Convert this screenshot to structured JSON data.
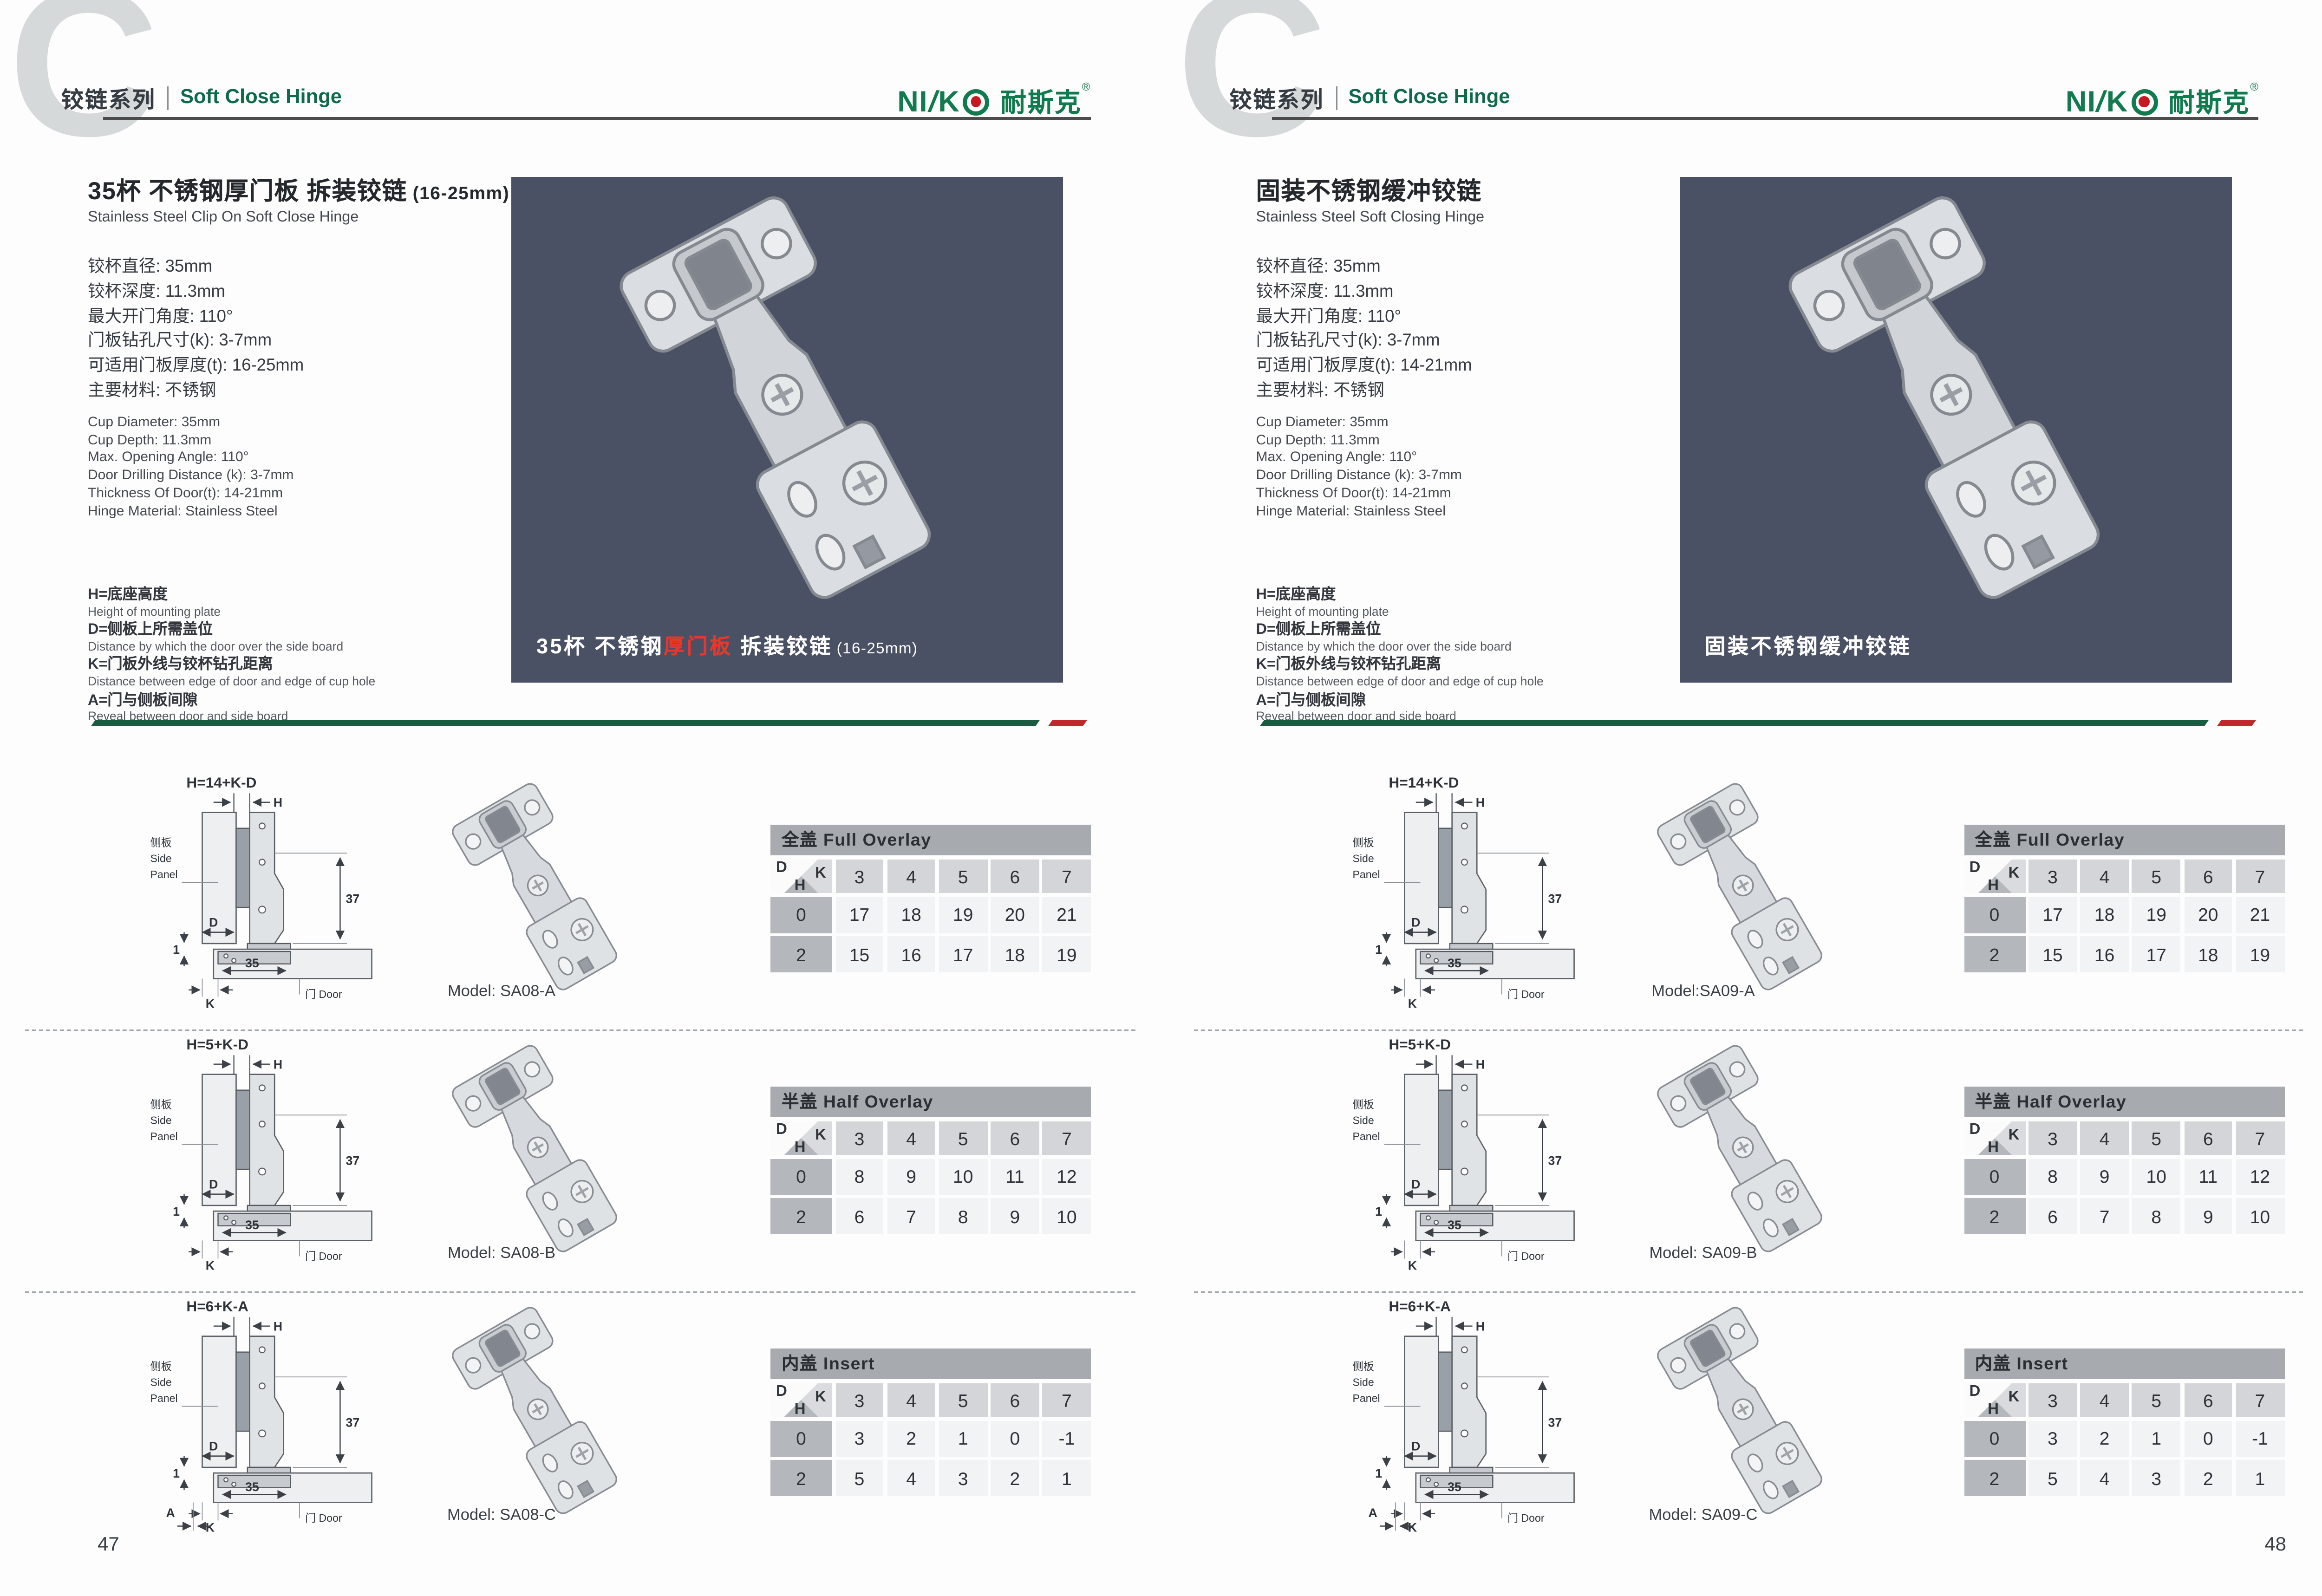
{
  "brand": {
    "logo_en_1": "NI",
    "logo_slash": "/",
    "logo_en_2": "K",
    "logo_cn": "耐斯克",
    "logo_reg": "®"
  },
  "header": {
    "letter": "C",
    "series_cn": "铰链系列",
    "series_en": "Soft Close Hinge"
  },
  "diagram_labels": {
    "h": "H",
    "d": "D",
    "k": "K",
    "a": "A",
    "one": "1",
    "thirtyseven": "37",
    "thirtyfive": "35",
    "side_cn": "侧板",
    "side_en_1": "Side",
    "side_en_2": "Panel",
    "door": "门 Door",
    "corner_d": "D",
    "corner_k": "K",
    "corner_h": "H"
  },
  "pages": [
    {
      "number": "47",
      "title_cn": "35杯 不锈钢厚门板 拆装铰链",
      "title_suffix": "(16-25mm)",
      "title_en": "Stainless Steel Clip On Soft Close Hinge",
      "specs_cn": [
        "铰杯直径: 35mm",
        "铰杯深度: 11.3mm",
        "最大开门角度: 110°",
        "门板钻孔尺寸(k): 3-7mm",
        "可适用门板厚度(t): 16-25mm",
        "主要材料: 不锈钢"
      ],
      "specs_en": [
        "Cup Diameter: 35mm",
        "Cup Depth: 11.3mm",
        "Max. Opening Angle: 110°",
        "Door Drilling Distance (k): 3-7mm",
        "Thickness Of Door(t): 14-21mm",
        "Hinge Material: Stainless Steel"
      ],
      "legend": [
        {
          "cn": "H=底座高度",
          "en": "Height of mounting plate"
        },
        {
          "cn": "D=侧板上所需盖位",
          "en": "Distance by which the door over the side board"
        },
        {
          "cn": "K=门板外线与铰杯钻孔距离",
          "en": "Distance between edge of door and edge of cup hole"
        },
        {
          "cn": "A=门与侧板间隙",
          "en": "Reveal between door and side board"
        }
      ],
      "caption": {
        "pre": "35杯 不锈钢",
        "red": "厚门板",
        "post": " 拆装铰链",
        "suffix": "(16-25mm)"
      },
      "sections": [
        {
          "formula": "H=14+K-D",
          "model": "Model: SA08-A",
          "dim_a": false,
          "table": {
            "title": "全盖 Full Overlay",
            "cols": [
              "3",
              "4",
              "5",
              "6",
              "7"
            ],
            "rows": [
              {
                "label": "0",
                "cells": [
                  "17",
                  "18",
                  "19",
                  "20",
                  "21"
                ]
              },
              {
                "label": "2",
                "cells": [
                  "15",
                  "16",
                  "17",
                  "18",
                  "19"
                ]
              }
            ]
          }
        },
        {
          "formula": "H=5+K-D",
          "model": "Model: SA08-B",
          "dim_a": false,
          "table": {
            "title": "半盖 Half Overlay",
            "cols": [
              "3",
              "4",
              "5",
              "6",
              "7"
            ],
            "rows": [
              {
                "label": "0",
                "cells": [
                  "8",
                  "9",
                  "10",
                  "11",
                  "12"
                ]
              },
              {
                "label": "2",
                "cells": [
                  "6",
                  "7",
                  "8",
                  "9",
                  "10"
                ]
              }
            ]
          }
        },
        {
          "formula": "H=6+K-A",
          "model": "Model: SA08-C",
          "dim_a": true,
          "table": {
            "title": "内盖 Insert",
            "cols": [
              "3",
              "4",
              "5",
              "6",
              "7"
            ],
            "rows": [
              {
                "label": "0",
                "cells": [
                  "3",
                  "2",
                  "1",
                  "0",
                  "-1"
                ]
              },
              {
                "label": "2",
                "cells": [
                  "5",
                  "4",
                  "3",
                  "2",
                  "1"
                ]
              }
            ]
          }
        }
      ]
    },
    {
      "number": "48",
      "title_cn": "固装不锈钢缓冲铰链",
      "title_suffix": "",
      "title_en": "Stainless Steel Soft Closing Hinge",
      "specs_cn": [
        "铰杯直径: 35mm",
        "铰杯深度: 11.3mm",
        "最大开门角度: 110°",
        "门板钻孔尺寸(k): 3-7mm",
        "可适用门板厚度(t): 14-21mm",
        "主要材料: 不锈钢"
      ],
      "specs_en": [
        "Cup Diameter: 35mm",
        "Cup Depth: 11.3mm",
        "Max. Opening Angle: 110°",
        "Door Drilling Distance (k): 3-7mm",
        "Thickness Of Door(t): 14-21mm",
        "Hinge Material: Stainless Steel"
      ],
      "legend": [
        {
          "cn": "H=底座高度",
          "en": "Height of mounting plate"
        },
        {
          "cn": "D=侧板上所需盖位",
          "en": "Distance by which the door over the side board"
        },
        {
          "cn": "K=门板外线与铰杯钻孔距离",
          "en": "Distance between edge of door and edge of cup hole"
        },
        {
          "cn": "A=门与侧板间隙",
          "en": "Reveal between door and side board"
        }
      ],
      "caption": {
        "pre": "固装不锈钢缓冲铰链",
        "red": "",
        "post": "",
        "suffix": ""
      },
      "sections": [
        {
          "formula": "H=14+K-D",
          "model": "Model:SA09-A",
          "dim_a": false,
          "table": {
            "title": "全盖 Full Overlay",
            "cols": [
              "3",
              "4",
              "5",
              "6",
              "7"
            ],
            "rows": [
              {
                "label": "0",
                "cells": [
                  "17",
                  "18",
                  "19",
                  "20",
                  "21"
                ]
              },
              {
                "label": "2",
                "cells": [
                  "15",
                  "16",
                  "17",
                  "18",
                  "19"
                ]
              }
            ]
          }
        },
        {
          "formula": "H=5+K-D",
          "model": "Model: SA09-B",
          "dim_a": false,
          "table": {
            "title": "半盖 Half Overlay",
            "cols": [
              "3",
              "4",
              "5",
              "6",
              "7"
            ],
            "rows": [
              {
                "label": "0",
                "cells": [
                  "8",
                  "9",
                  "10",
                  "11",
                  "12"
                ]
              },
              {
                "label": "2",
                "cells": [
                  "6",
                  "7",
                  "8",
                  "9",
                  "10"
                ]
              }
            ]
          }
        },
        {
          "formula": "H=6+K-A",
          "model": "Model: SA09-C",
          "dim_a": true,
          "table": {
            "title": "内盖 Insert",
            "cols": [
              "3",
              "4",
              "5",
              "6",
              "7"
            ],
            "rows": [
              {
                "label": "0",
                "cells": [
                  "3",
                  "2",
                  "1",
                  "0",
                  "-1"
                ]
              },
              {
                "label": "2",
                "cells": [
                  "5",
                  "4",
                  "3",
                  "2",
                  "1"
                ]
              }
            ]
          }
        }
      ]
    }
  ]
}
